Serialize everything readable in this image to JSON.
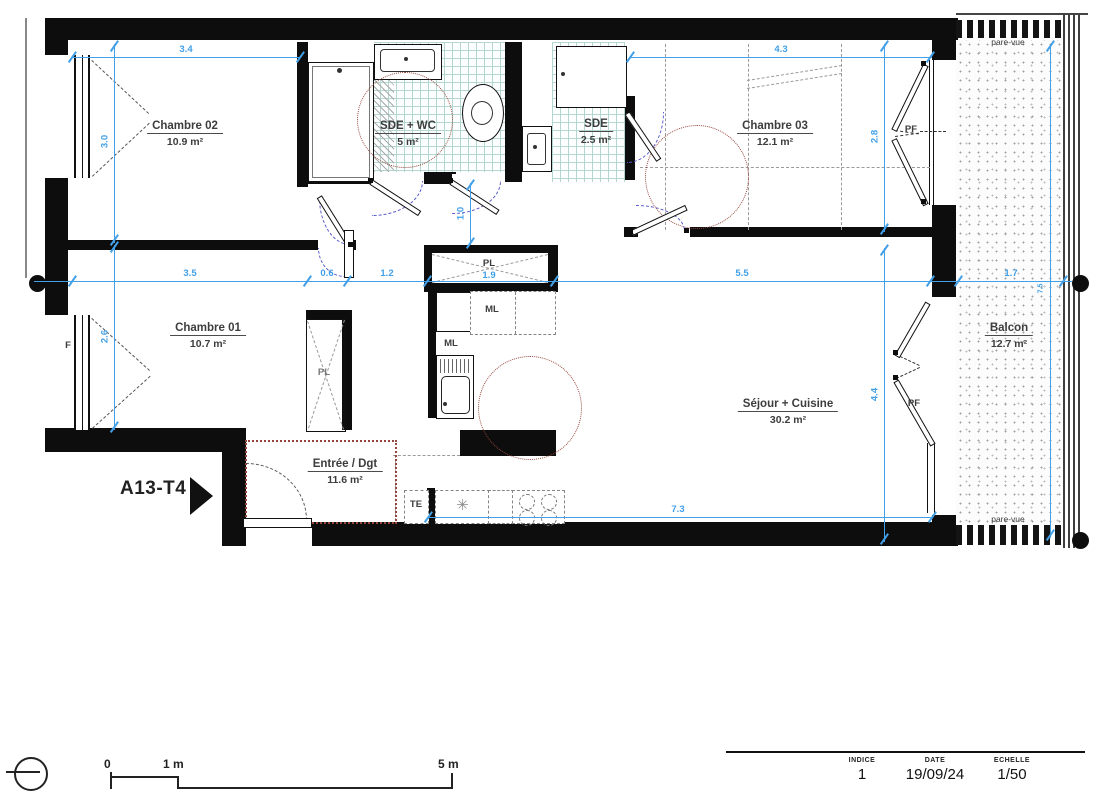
{
  "title": {
    "unit": "A13-T4"
  },
  "rooms": {
    "chambre02": {
      "name": "Chambre 02",
      "area": "10.9 m²"
    },
    "sde_wc": {
      "name": "SDE + WC",
      "area": "5 m²"
    },
    "sde": {
      "name": "SDE",
      "area": "2.5 m²"
    },
    "chambre03": {
      "name": "Chambre 03",
      "area": "12.1 m²"
    },
    "chambre01": {
      "name": "Chambre 01",
      "area": "10.7 m²"
    },
    "sejour": {
      "name": "Séjour + Cuisine",
      "area": "30.2 m²"
    },
    "entree": {
      "name": "Entrée / Dgt",
      "area": "11.6 m²"
    },
    "balcon": {
      "name": "Balcon",
      "area": "12.7 m²"
    }
  },
  "dimensions": {
    "w_chambre02": "3.4",
    "w_chambre03": "4.3",
    "h_chambre02": "3.0",
    "h_chambre03": "2.8",
    "w_chambre01": "3.5",
    "w_hall_a": "0.6",
    "w_hall_b": "1.2",
    "w_kitchen_pl": "1.9",
    "w_sejour": "5.5",
    "w_balcon": "1.7",
    "h_chambre01": "2.6",
    "h_wc_door": "1.0",
    "h_sejour": "4.4",
    "w_sejour_bottom": "7.3",
    "h_balcon": "7.5"
  },
  "labels": {
    "pare_vue": "pare-vue",
    "pf": "PF",
    "pl": "PL",
    "ml": "ML",
    "te": "TE",
    "f": "F"
  },
  "icons": {
    "fridge_snowflake": "✳"
  },
  "scale_bar": {
    "zero": "0",
    "one": "1 m",
    "five": "5 m"
  },
  "title_block": {
    "indice_label": "INDICE",
    "indice_value": "1",
    "date_label": "DATE",
    "date_value": "19/09/24",
    "scale_label": "ECHELLE",
    "scale_value": "1/50"
  },
  "colors": {
    "wall": "#0d0d0d",
    "dimension_blue": "#42a0e8",
    "tile_teal": "#b4d6d1",
    "turning_circle": "#96463c",
    "door_swing": "#5558c8"
  }
}
